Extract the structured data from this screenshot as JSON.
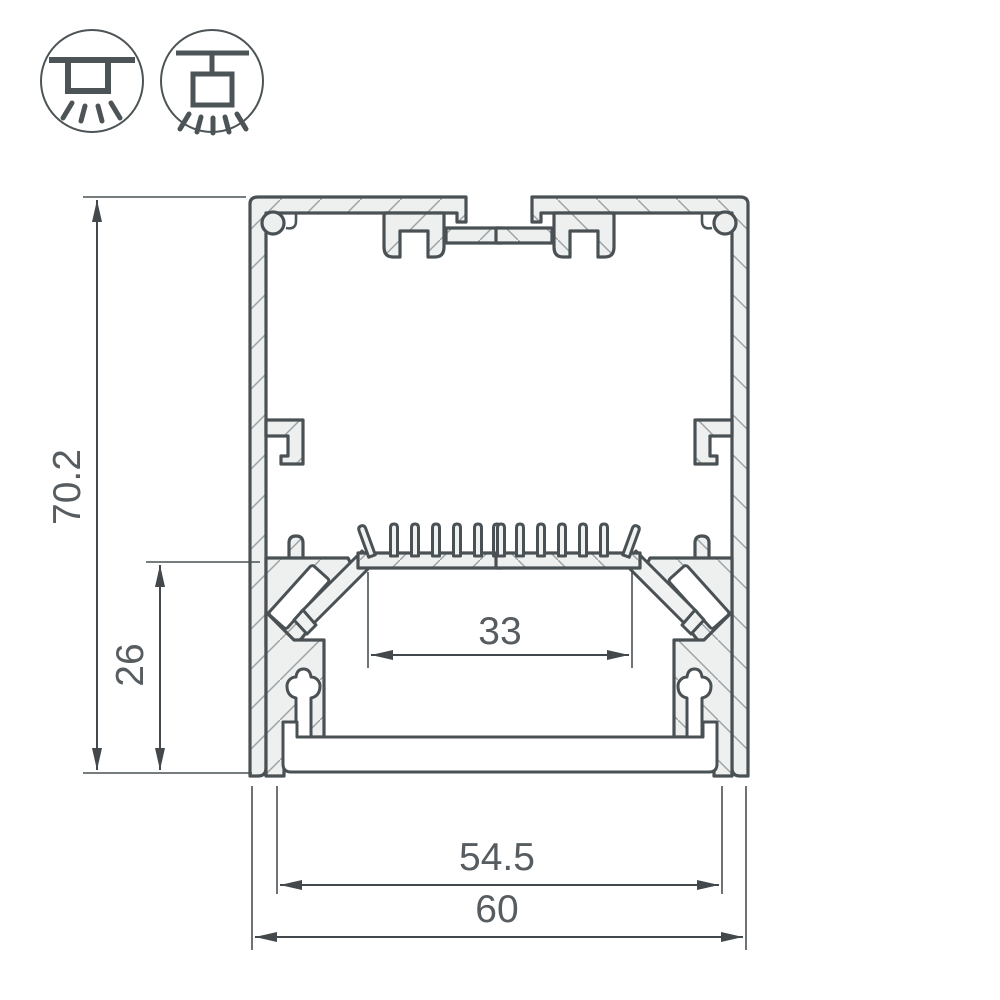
{
  "page": {
    "background_color": "#ffffff",
    "content_type": "dimensioned engineering cross-section drawing of an aluminium LED profile with hatched cut surfaces"
  },
  "mounting_legend": {
    "icons": [
      {
        "name": "surface-mount-luminaire-icon",
        "meaning": "surface / ceiling mounted profile, light emitted downward"
      },
      {
        "name": "pendant-mount-luminaire-icon",
        "meaning": "suspended (pendant) profile, light emitted downward"
      }
    ]
  },
  "drawing": {
    "dimensions": {
      "overall_height": "70.2",
      "inner_height": "26",
      "led_platform_width": "33",
      "diffuser_width": "54.5",
      "overall_width": "60"
    },
    "features": [
      "finned heatsink LED platform",
      "top T-slot channels",
      "corner screw ports",
      "side mounting hooks",
      "bottom opal diffuser plate"
    ],
    "colors": {
      "outline": "#4a5154",
      "cut_fill": "#eeefef",
      "hatch_lines": "#9aa1a4",
      "dimension_lines": "#42484b",
      "label_text": "#565c5f"
    }
  }
}
